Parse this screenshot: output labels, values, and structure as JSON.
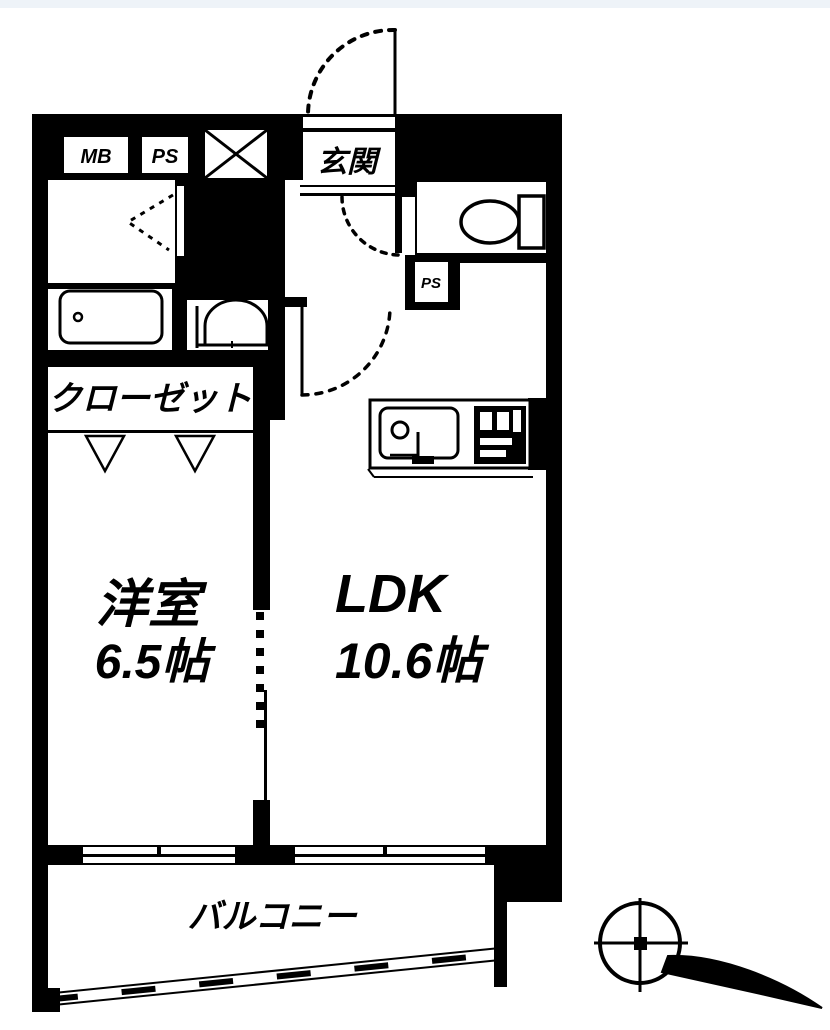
{
  "document": {
    "type": "apartment-floor-plan",
    "style": "black-and-white scanned line drawing"
  },
  "colors": {
    "ink": "#000000",
    "paper": "#ffffff",
    "scan_tint_top": "#eef3f8"
  },
  "labels": {
    "entrance": "玄関",
    "meter_box": "MB",
    "pipe_space_top": "PS",
    "pipe_space_small": "PS",
    "closet": "クローゼット",
    "western_room_name": "洋室",
    "western_room_size": "6.5帖",
    "ldk_name": "LDK",
    "ldk_size": "10.6帖",
    "balcony": "バルコニー"
  },
  "rooms": [
    {
      "name": "玄関",
      "size": ""
    },
    {
      "name": "洋室",
      "size": "6.5帖"
    },
    {
      "name": "LDK",
      "size": "10.6帖"
    },
    {
      "name": "クローゼット",
      "size": ""
    },
    {
      "name": "バルコニー",
      "size": ""
    }
  ],
  "symbols": [
    "entrance-door-arc",
    "toilet-door-arc",
    "ldk-door-arc",
    "folding-door-mark",
    "shaft-x-box",
    "bathtub",
    "washbasin",
    "toilet",
    "kitchen-sink",
    "stove-grill",
    "closet-hanger-marks",
    "window-openings",
    "sliding-partition-dashed-wall",
    "balcony-railing",
    "compass-north-arrow"
  ]
}
